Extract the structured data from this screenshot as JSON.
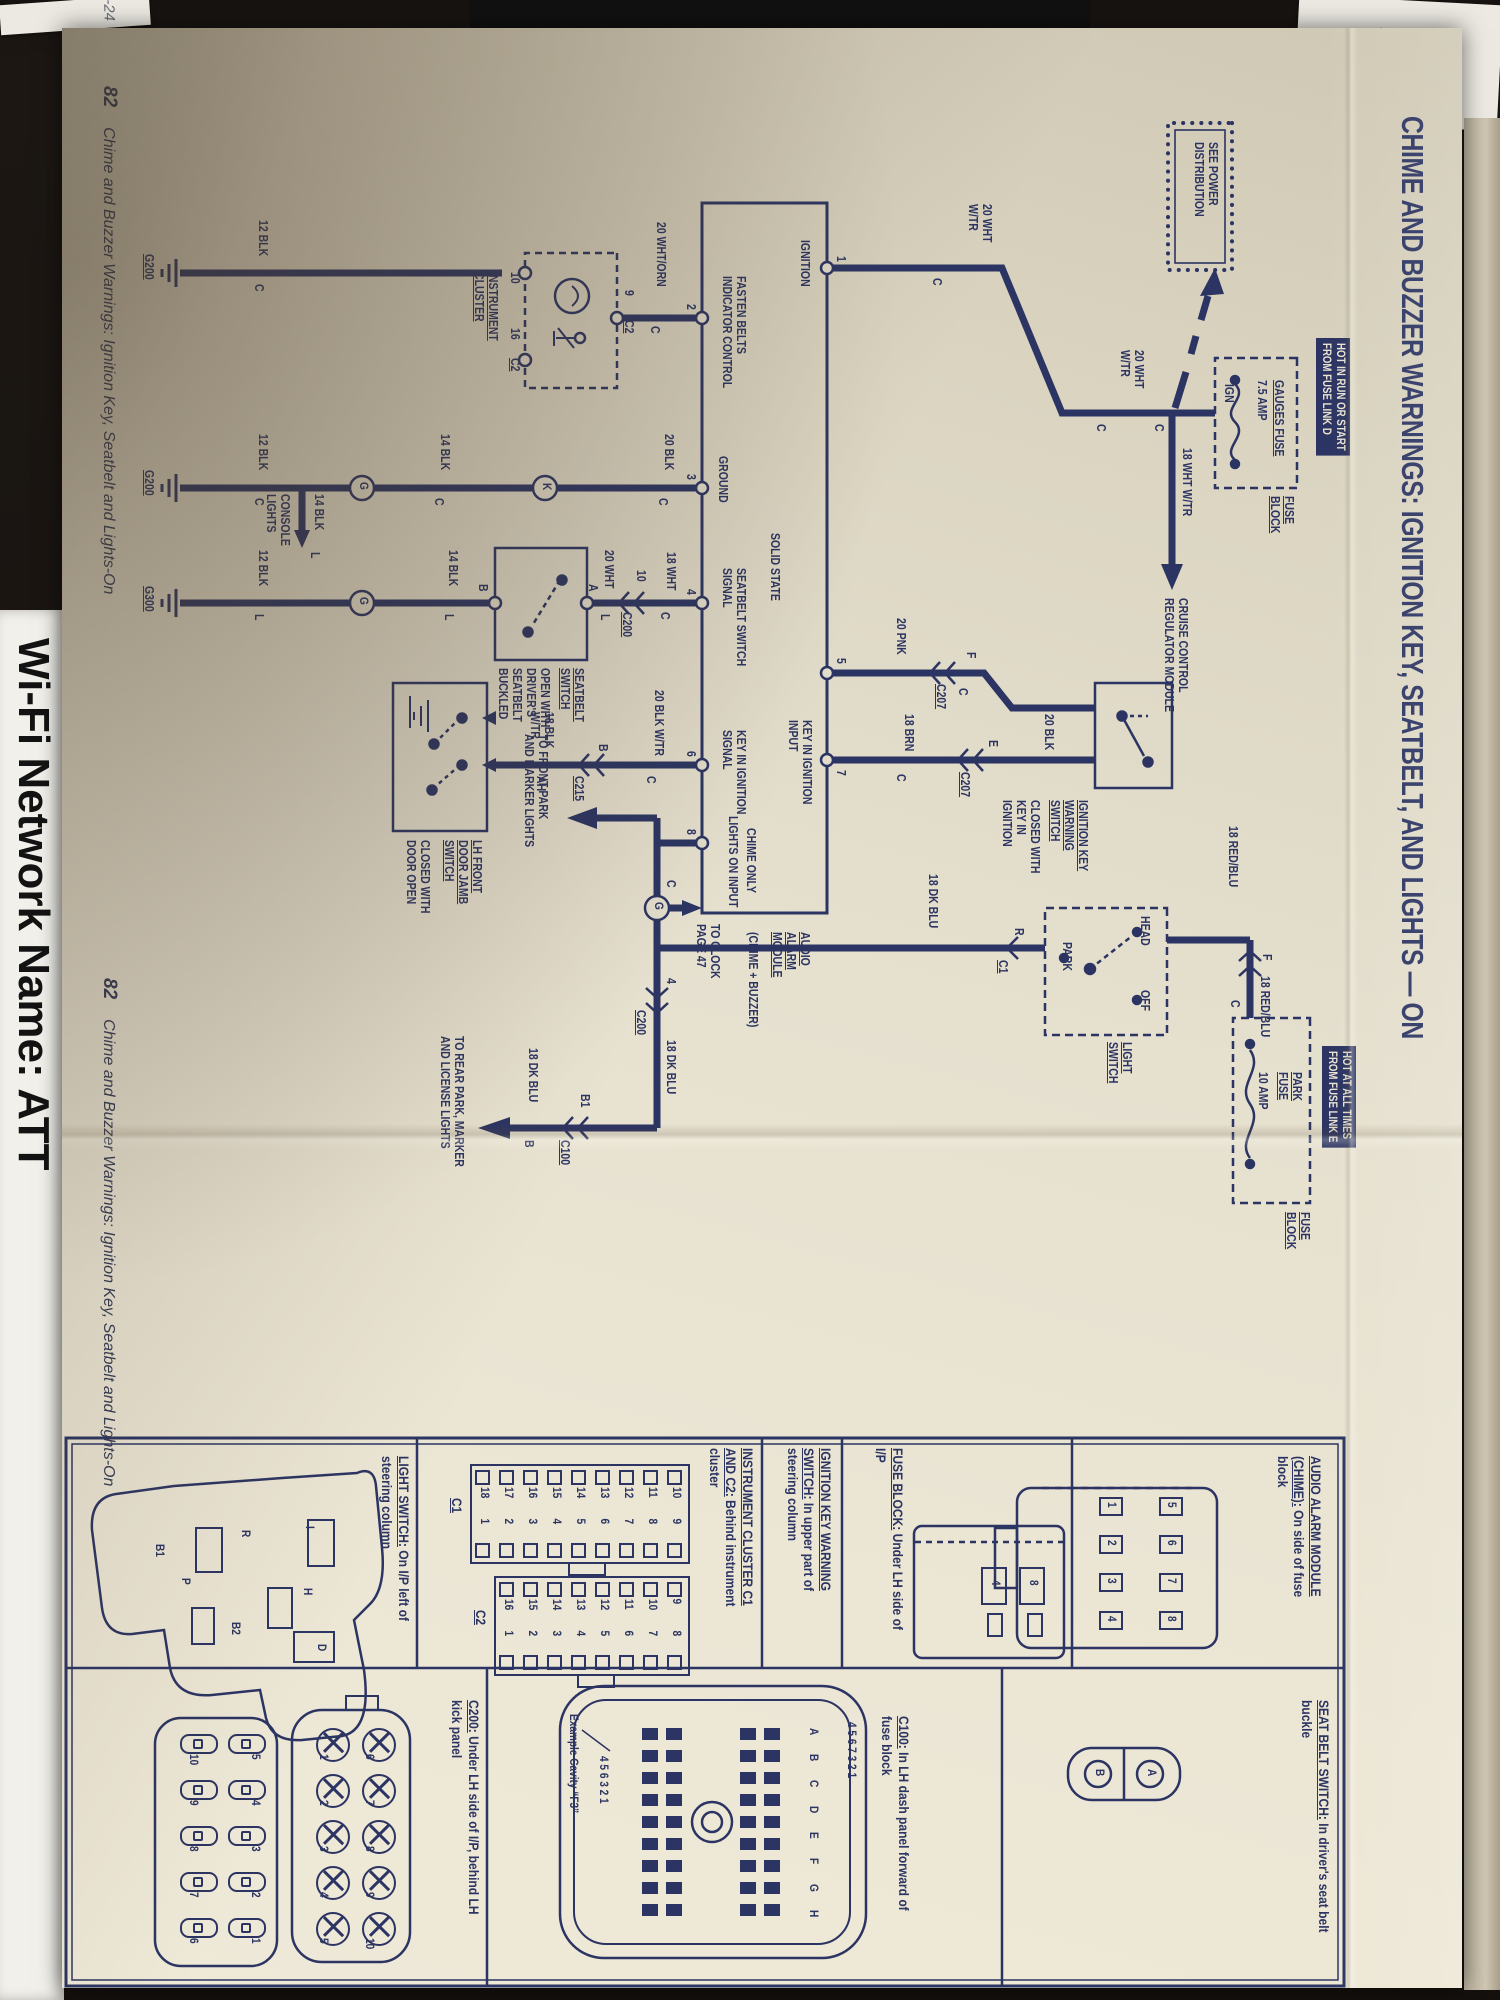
{
  "page": {
    "title": "CHIME AND BUZZER WARNINGS: IGNITION KEY, SEATBELT, AND LIGHTS — ON",
    "footer_left": {
      "num": "82",
      "text": "Chime and Buzzer Warnings: Ignition Key, Seatbelt and Lights-On"
    },
    "footer_right": {
      "num": "82",
      "text": "Chime and Buzzer Warnings: Ignition Key, Seatbelt and Lights-On"
    }
  },
  "background": {
    "handwriting_dc": "D.C",
    "handwriting_mat": "-24",
    "wifi_text": "Wi-Fi Network Name: ATT"
  },
  "schematic": {
    "labels": [
      {
        "t": "SEE POWER\nDISTRIBUTION",
        "x": 114,
        "y": 242
      },
      {
        "t": "HOT IN RUN OR START\nFROM FUSE LINK D",
        "x": 310,
        "y": 112,
        "c": "inv"
      },
      {
        "t": "GAUGES FUSE",
        "x": 352,
        "y": 176,
        "c": "u"
      },
      {
        "t": "7.5 AMP",
        "x": 352,
        "y": 193
      },
      {
        "t": "IGN",
        "x": 356,
        "y": 226
      },
      {
        "t": "FUSE\nBLOCK",
        "x": 468,
        "y": 166,
        "c": "u"
      },
      {
        "t": "C",
        "x": 396,
        "y": 296
      },
      {
        "t": "18 WHT W/TR",
        "x": 420,
        "y": 268
      },
      {
        "t": "CRUISE CONTROL\nREGULATOR MODULE",
        "x": 570,
        "y": 272
      },
      {
        "t": "20 WHT\nW/TR",
        "x": 322,
        "y": 316
      },
      {
        "t": "C",
        "x": 396,
        "y": 354
      },
      {
        "t": "20 WHT\nW/TR",
        "x": 176,
        "y": 468
      },
      {
        "t": "C",
        "x": 250,
        "y": 518
      },
      {
        "t": "1",
        "x": 228,
        "y": 614
      },
      {
        "t": "IGNITION",
        "x": 212,
        "y": 650
      },
      {
        "t": "SOLID STATE",
        "x": 505,
        "y": 680
      },
      {
        "t": "AUDIO\nALARM\nMODULE",
        "x": 904,
        "y": 650,
        "c": "u"
      },
      {
        "t": "(CHIME + BUZZER)",
        "x": 904,
        "y": 702
      },
      {
        "t": "5",
        "x": 630,
        "y": 614
      },
      {
        "t": "7",
        "x": 742,
        "y": 614
      },
      {
        "t": "KEY IN IGNITION\nINPUT",
        "x": 692,
        "y": 648
      },
      {
        "t": "CHIME ONLY",
        "x": 800,
        "y": 704
      },
      {
        "t": "LIGHTS ON INPUT",
        "x": 788,
        "y": 722
      },
      {
        "t": "FASTEN BELTS\nINDICATOR CONTROL",
        "x": 248,
        "y": 714
      },
      {
        "t": "GROUND",
        "x": 428,
        "y": 732
      },
      {
        "t": "SEATBELT SWITCH\nSIGNAL",
        "x": 540,
        "y": 714
      },
      {
        "t": "KEY IN IGNITION\nSIGNAL",
        "x": 702,
        "y": 714
      },
      {
        "t": "2",
        "x": 276,
        "y": 764
      },
      {
        "t": "3",
        "x": 446,
        "y": 764
      },
      {
        "t": "4",
        "x": 561,
        "y": 764
      },
      {
        "t": "6",
        "x": 723,
        "y": 764
      },
      {
        "t": "8",
        "x": 801,
        "y": 764
      },
      {
        "t": "IGNITION KEY\nWARNING\nSWITCH",
        "x": 772,
        "y": 372,
        "c": "u"
      },
      {
        "t": "CLOSED WITH\nKEY IN\nIGNITION",
        "x": 772,
        "y": 420
      },
      {
        "t": "20 BLK",
        "x": 686,
        "y": 406
      },
      {
        "t": "E",
        "x": 712,
        "y": 462
      },
      {
        "t": "C207",
        "x": 744,
        "y": 490,
        "c": "u"
      },
      {
        "t": "18 BRN",
        "x": 686,
        "y": 546
      },
      {
        "t": "C",
        "x": 746,
        "y": 554
      },
      {
        "t": "F",
        "x": 624,
        "y": 484
      },
      {
        "t": "C",
        "x": 660,
        "y": 492
      },
      {
        "t": "C207",
        "x": 656,
        "y": 514,
        "c": "u"
      },
      {
        "t": "20 PNK",
        "x": 590,
        "y": 554
      },
      {
        "t": "HOT AT ALL TIMES\nFROM FUSE LINK E",
        "x": 1018,
        "y": 106,
        "c": "inv"
      },
      {
        "t": "PARK\nFUSE",
        "x": 1044,
        "y": 158,
        "c": "u"
      },
      {
        "t": "10 AMP",
        "x": 1044,
        "y": 192
      },
      {
        "t": "FUSE\nBLOCK",
        "x": 1184,
        "y": 150,
        "c": "u"
      },
      {
        "t": "C",
        "x": 972,
        "y": 220
      },
      {
        "t": "18 RED/BLU",
        "x": 948,
        "y": 190
      },
      {
        "t": "F",
        "x": 926,
        "y": 188
      },
      {
        "t": "18 RED/BLU",
        "x": 798,
        "y": 222
      },
      {
        "t": "HEAD",
        "x": 888,
        "y": 310
      },
      {
        "t": "OFF",
        "x": 962,
        "y": 310
      },
      {
        "t": "PARK",
        "x": 914,
        "y": 388
      },
      {
        "t": "LIGHT\nSWITCH",
        "x": 1014,
        "y": 328,
        "c": "u"
      },
      {
        "t": "R",
        "x": 900,
        "y": 436
      },
      {
        "t": "C1",
        "x": 932,
        "y": 452,
        "c": "u"
      },
      {
        "t": "18 DK BLU",
        "x": 846,
        "y": 522
      },
      {
        "t": "C",
        "x": 852,
        "y": 784
      },
      {
        "t": "TO CLOCK\nPAGE 47",
        "x": 896,
        "y": 740
      },
      {
        "t": "4",
        "x": 950,
        "y": 784
      },
      {
        "t": "C200",
        "x": 982,
        "y": 814,
        "c": "u"
      },
      {
        "t": "18 DK BLU",
        "x": 1012,
        "y": 784
      },
      {
        "t": "B1",
        "x": 1066,
        "y": 870
      },
      {
        "t": "C100",
        "x": 1112,
        "y": 890,
        "c": "u"
      },
      {
        "t": "B",
        "x": 1112,
        "y": 926
      },
      {
        "t": "18 DK BLU",
        "x": 1020,
        "y": 922
      },
      {
        "t": "TO REAR PARK, MARKER\nAND LICENSE LIGHTS",
        "x": 1008,
        "y": 996
      },
      {
        "t": "TO FRONT PARK\nAND MARKER LIGHTS",
        "x": 706,
        "y": 912
      },
      {
        "t": "20 BLK W/TR",
        "x": 662,
        "y": 796
      },
      {
        "t": "C",
        "x": 748,
        "y": 804
      },
      {
        "t": "B",
        "x": 716,
        "y": 852
      },
      {
        "t": "C215",
        "x": 748,
        "y": 876,
        "c": "u"
      },
      {
        "t": "18 BLK\nW/TR",
        "x": 684,
        "y": 906
      },
      {
        "t": "AH",
        "x": 748,
        "y": 914
      },
      {
        "t": "LH FRONT\nDOOR JAMB\nSWITCH",
        "x": 812,
        "y": 978,
        "c": "u"
      },
      {
        "t": "CLOSED WITH\nDOOR OPEN",
        "x": 812,
        "y": 1030
      },
      {
        "t": "18 WHT",
        "x": 524,
        "y": 784
      },
      {
        "t": "C",
        "x": 584,
        "y": 790
      },
      {
        "t": "10",
        "x": 542,
        "y": 814
      },
      {
        "t": "C200",
        "x": 584,
        "y": 828,
        "c": "u"
      },
      {
        "t": "20 WHT",
        "x": 522,
        "y": 846
      },
      {
        "t": "L",
        "x": 586,
        "y": 850
      },
      {
        "t": "A",
        "x": 556,
        "y": 862
      },
      {
        "t": "SEATBELT\nSWITCH",
        "x": 640,
        "y": 876,
        "c": "u"
      },
      {
        "t": "OPEN WITH\nDRIVER'S\nSEATBELT\nBUCKLED",
        "x": 640,
        "y": 910
      },
      {
        "t": "B",
        "x": 556,
        "y": 972
      },
      {
        "t": "14 BLK",
        "x": 522,
        "y": 1002
      },
      {
        "t": "L",
        "x": 586,
        "y": 1006
      },
      {
        "t": "12 BLK",
        "x": 522,
        "y": 1192
      },
      {
        "t": "L",
        "x": 586,
        "y": 1196
      },
      {
        "t": "G300",
        "x": 558,
        "y": 1306,
        "c": "u"
      },
      {
        "t": "20 BLK",
        "x": 406,
        "y": 786
      },
      {
        "t": "C",
        "x": 470,
        "y": 792
      },
      {
        "t": "14 BLK",
        "x": 406,
        "y": 1010
      },
      {
        "t": "C",
        "x": 470,
        "y": 1016
      },
      {
        "t": "12 BLK",
        "x": 406,
        "y": 1192
      },
      {
        "t": "C",
        "x": 470,
        "y": 1196
      },
      {
        "t": "G200",
        "x": 442,
        "y": 1306,
        "c": "u"
      },
      {
        "t": "14 BLK",
        "x": 466,
        "y": 1136
      },
      {
        "t": "L",
        "x": 524,
        "y": 1140
      },
      {
        "t": "CONSOLE\nLIGHTS",
        "x": 466,
        "y": 1170
      },
      {
        "t": "20 WHT/ORN",
        "x": 194,
        "y": 794
      },
      {
        "t": "C",
        "x": 298,
        "y": 800
      },
      {
        "t": "9",
        "x": 262,
        "y": 826
      },
      {
        "t": "C2",
        "x": 292,
        "y": 826,
        "c": "u"
      },
      {
        "t": "10",
        "x": 244,
        "y": 940
      },
      {
        "t": "16",
        "x": 300,
        "y": 940
      },
      {
        "t": "C2",
        "x": 330,
        "y": 940,
        "c": "u"
      },
      {
        "t": "INSTRUMENT\nCLUSTER",
        "x": 244,
        "y": 962,
        "c": "u"
      },
      {
        "t": "12 BLK",
        "x": 192,
        "y": 1192
      },
      {
        "t": "C",
        "x": 256,
        "y": 1196
      },
      {
        "t": "G200",
        "x": 226,
        "y": 1306,
        "c": "u"
      },
      {
        "t": "K",
        "x": 455,
        "y": 909,
        "c": "fig"
      },
      {
        "t": "G",
        "x": 454,
        "y": 1092,
        "c": "fig"
      },
      {
        "t": "G",
        "x": 569,
        "y": 1092,
        "c": "fig"
      },
      {
        "t": "G",
        "x": 874,
        "y": 797,
        "c": "fig"
      }
    ]
  },
  "locator": {
    "headings": [
      {
        "strong": "AUDIO ALARM MODULE (CHIME):",
        "rest": "On side of fuse block",
        "x": 1428,
        "y": 138,
        "w": 170
      },
      {
        "strong": "SEAT BELT SWITCH:",
        "rest": "In driver's seat belt buckle",
        "x": 1672,
        "y": 130,
        "w": 280
      },
      {
        "strong": "FUSE BLOCK:",
        "rest": "Under LH side of I/P",
        "x": 1420,
        "y": 556,
        "w": 225
      },
      {
        "strong": "IGNITION KEY WARNING SWITCH:",
        "rest": "In upper part of steering column",
        "x": 1420,
        "y": 628,
        "w": 205
      },
      {
        "strong": "INSTRUMENT CLUSTER C1 AND C2:",
        "rest": "Behind instrument cluster",
        "x": 1420,
        "y": 706,
        "w": 205
      },
      {
        "strong": "C100:",
        "rest": "In LH dash panel forward of fuse block",
        "x": 1688,
        "y": 550,
        "w": 245
      },
      {
        "strong": "LIGHT SWITCH:",
        "rest": "On I/P left of steering column",
        "x": 1428,
        "y": 1050,
        "w": 215
      },
      {
        "strong": "C200:",
        "rest": "Under LH side of I/P, behind LH kick panel",
        "x": 1672,
        "y": 980,
        "w": 265
      }
    ],
    "figures": {
      "audio_pins_top": [
        "5",
        "6",
        "7",
        "8"
      ],
      "audio_pins_bottom": [
        "1",
        "2",
        "3",
        "4"
      ],
      "seatbelt_pins": [
        "A",
        "B"
      ],
      "fuse_pins": [
        "8",
        "4"
      ],
      "c1": {
        "label": "C1",
        "rows": [
          [
            10,
            9
          ],
          [
            11,
            8
          ],
          [
            12,
            7
          ],
          [
            13,
            6
          ],
          [
            14,
            5
          ],
          [
            15,
            4
          ],
          [
            16,
            3
          ],
          [
            17,
            2
          ],
          [
            18,
            1
          ]
        ]
      },
      "c2": {
        "label": "C2",
        "rows": [
          [
            9,
            8
          ],
          [
            10,
            7
          ],
          [
            11,
            6
          ],
          [
            12,
            5
          ],
          [
            13,
            4
          ],
          [
            14,
            3
          ],
          [
            15,
            2
          ],
          [
            16,
            1
          ]
        ]
      },
      "c100": {
        "letters": "A B C D E F G H",
        "top_nums": "4 5 6 7    3 2 1",
        "bottom_nums": "4 5 6    3 2 1",
        "cavity_note": "Example Cavity “F3”"
      },
      "c200a": {
        "top": [
          "6",
          "7",
          "8",
          "9",
          "10"
        ],
        "bottom": [
          "1",
          "2",
          "3",
          "4",
          "5"
        ]
      },
      "c200b": {
        "top": [
          "5",
          "4",
          "3",
          "2",
          "1"
        ],
        "bottom": [
          "10",
          "9",
          "8",
          "7",
          "6"
        ]
      },
      "light_pins": [
        "B1",
        "P",
        "R",
        "I",
        "H",
        "B2",
        "D"
      ]
    }
  }
}
